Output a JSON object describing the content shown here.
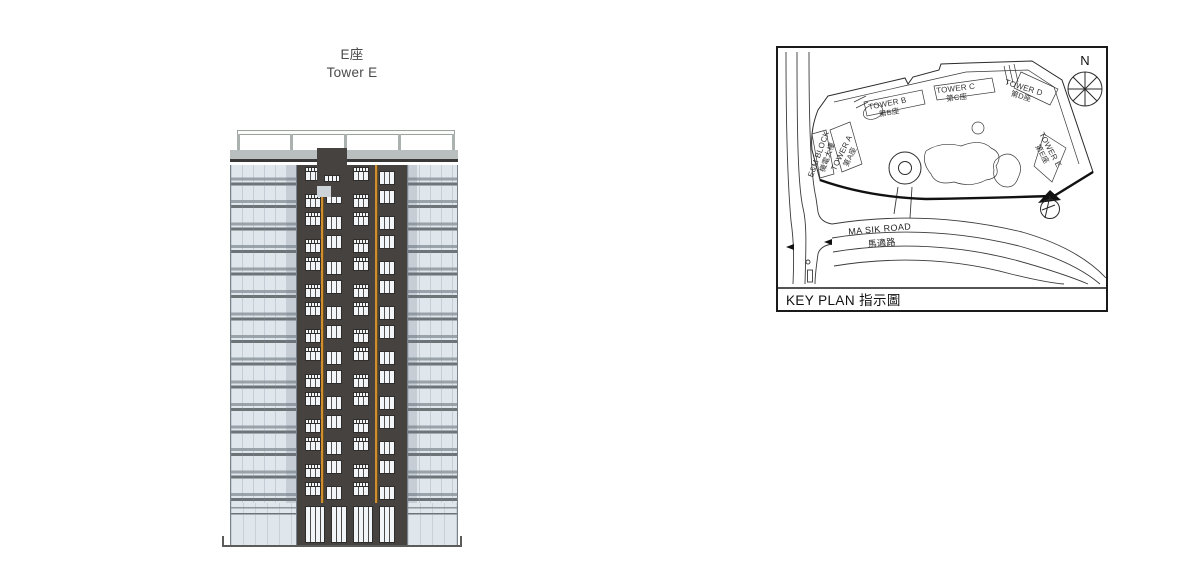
{
  "title": {
    "zh": "E座",
    "en": "Tower E"
  },
  "elevation": {
    "floors": 15,
    "windows_per_floor": 4,
    "window_columns_x": [
      8,
      29,
      56,
      82
    ],
    "ground_windows": {
      "x": [
        8,
        34,
        56,
        82
      ],
      "w": [
        20,
        16,
        20,
        16
      ]
    },
    "trellis_posts_x": [
      0,
      53,
      107,
      161,
      215
    ],
    "colors": {
      "glass": "#dfe6ec",
      "band_mid": "#9aa3a9",
      "band_dark": "#6d7478",
      "core": "#45423f",
      "accent": "#cf8f31",
      "parapet": "#b8bfbe",
      "window": "#f2f5f7",
      "frame": "#2f2d2b"
    }
  },
  "key_plan": {
    "caption": "KEY PLAN 指示圖",
    "north_label": "N",
    "road": {
      "en": "MA SIK ROAD",
      "zh": "馬適路"
    },
    "labels": [
      {
        "id": "em-block",
        "en": "E&M BLOCK",
        "zh": "機電大樓"
      },
      {
        "id": "tower-a",
        "en": "TOWER A",
        "zh": "第A座"
      },
      {
        "id": "tower-b",
        "en": "TOWER B",
        "zh": "第B座"
      },
      {
        "id": "tower-c",
        "en": "TOWER C",
        "zh": "第C座"
      },
      {
        "id": "tower-d",
        "en": "TOWER D",
        "zh": "第D座"
      },
      {
        "id": "tower-e",
        "en": "TOWER E",
        "zh": "第E座"
      }
    ]
  }
}
